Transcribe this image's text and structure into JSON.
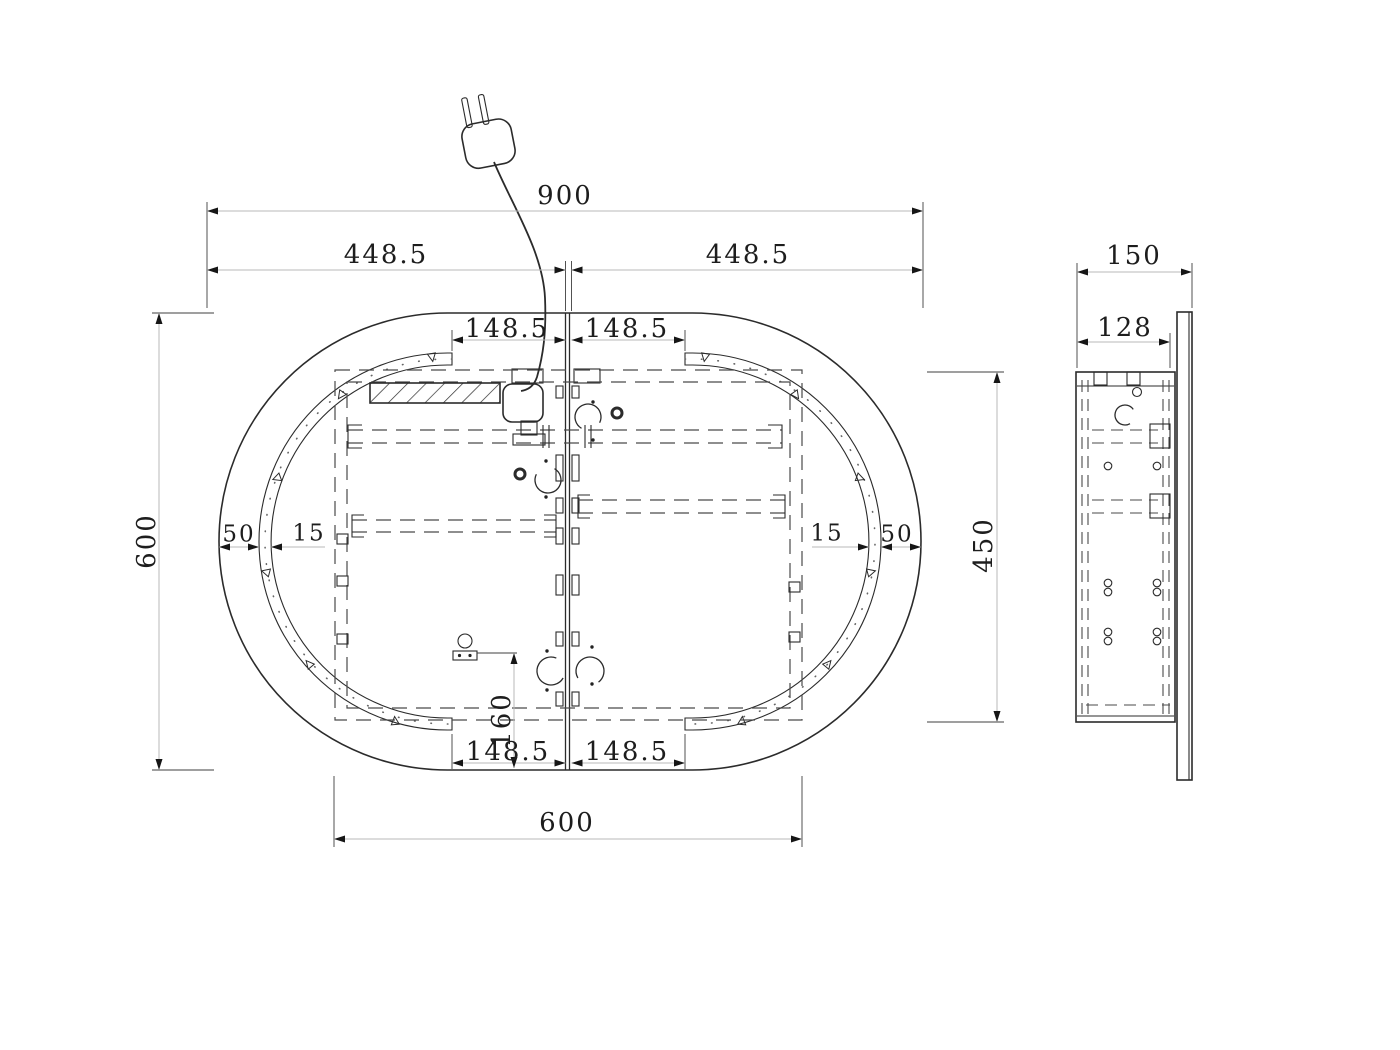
{
  "dimensions": {
    "front": {
      "overall_width": "900",
      "half_width_left": "448.5",
      "half_width_right": "448.5",
      "led_end_top_left": "148.5",
      "led_end_top_right": "148.5",
      "overall_height": "600",
      "edge_to_led_left": "50",
      "led_width_left": "15",
      "led_width_right": "15",
      "edge_to_led_right": "50",
      "backbox_height": "450",
      "sensor_offset_bottom": "160",
      "led_end_bottom_left": "148.5",
      "led_end_bottom_right": "148.5",
      "backbox_width": "600"
    },
    "side": {
      "overall_depth": "150",
      "backbox_depth": "128"
    }
  }
}
